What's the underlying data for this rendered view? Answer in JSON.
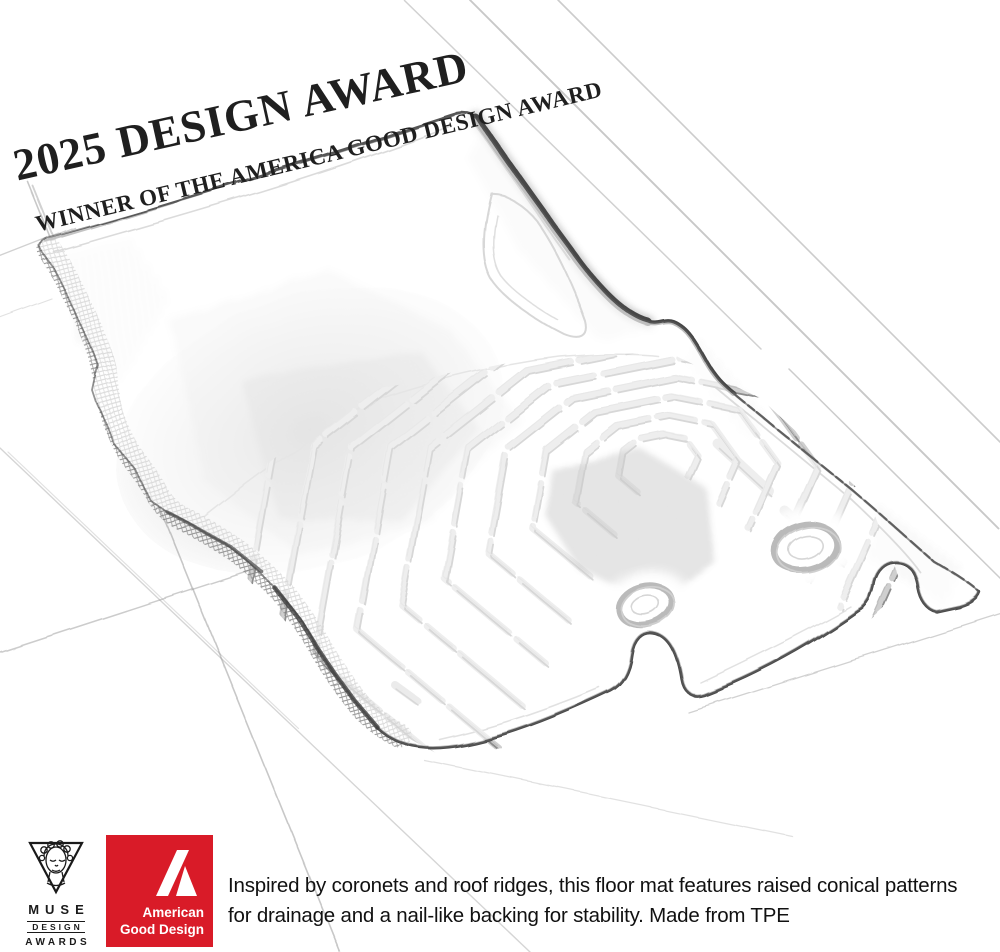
{
  "page": {
    "background": "#ffffff"
  },
  "award_badge": {
    "line1": "2025 DESIGN AWARD",
    "line2": "WINNER OF THE AMERICA GOOD DESIGN AWARD",
    "color": "#1f1f1f"
  },
  "caption": {
    "text": "Inspired by coronets and roof ridges, this floor mat features raised conical patterns for drainage and a nail-like backing for stability. Made from TPE",
    "color": "#111111"
  },
  "logos": {
    "muse": {
      "title": "MUSE",
      "subtitle": "DESIGN",
      "subtitle2": "AWARDS",
      "icon": "muse-goddess-triangle-icon",
      "color": "#1a1a1a"
    },
    "american_good_design": {
      "line1": "American",
      "line2": "Good Design",
      "icon": "agd-monogram-a-icon",
      "bg_color": "#d91b28",
      "text_color": "#ffffff"
    }
  },
  "sketch": {
    "subject": "pencil sketch of a car floor mat with chevron ridge pattern and two fastening grommets",
    "pencil_color": "#3f3f3f",
    "grid_color": "#9a9a9a"
  }
}
